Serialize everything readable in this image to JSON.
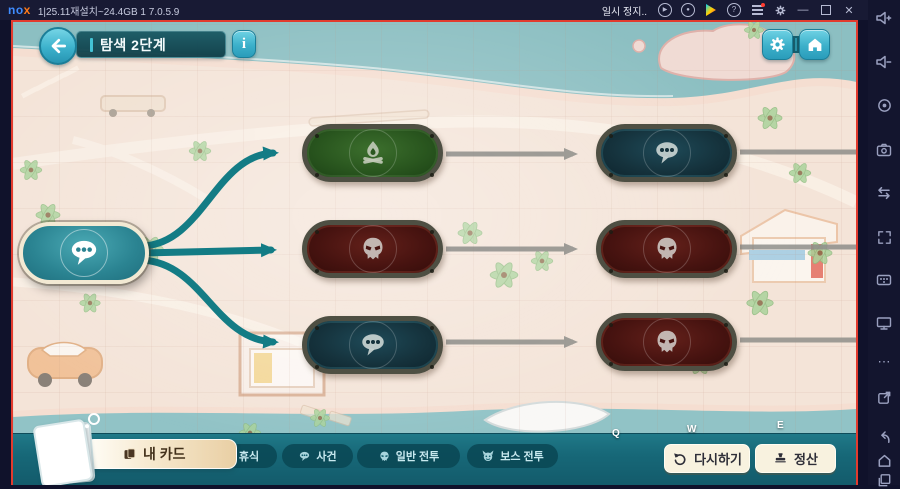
{
  "emulator": {
    "titlebar": {
      "logo_no": "no",
      "logo_x": "x",
      "window_title": "1|25.11재설치~24.4GB 1 7.0.5.9",
      "pause_text": "일시 정지..",
      "play_glyph": "▶",
      "record_glyph": "●",
      "help_glyph": "?",
      "minimize_glyph": "—",
      "close_glyph": "✕",
      "icons": [
        "play-circle-icon",
        "record-circle-icon",
        "google-play-icon",
        "help-icon",
        "menu-icon",
        "settings-icon",
        "minimize-icon",
        "maximize-icon",
        "close-icon"
      ]
    },
    "side_toolbar": {
      "more_glyph": "⋯",
      "icons": [
        "volume-up-icon",
        "volume-down-icon",
        "screen-record-icon",
        "screenshot-icon",
        "swap-icon",
        "fullscreen-icon",
        "keymap-icon",
        "virtual-screen-icon",
        "more-icon",
        "open-external-icon"
      ],
      "nav_icons": [
        "nav-back-icon",
        "nav-home-icon",
        "nav-recents-icon"
      ]
    }
  },
  "game": {
    "header": {
      "stage_title": "탐색 2단계",
      "info_glyph": "i"
    },
    "keyboard_hints": {
      "q": "Q",
      "w": "W",
      "e": "E"
    },
    "map": {
      "start_node": {
        "type": "event",
        "icon": "speech-bubble-icon",
        "state": "current"
      },
      "column1": [
        {
          "row": 1,
          "type": "rest",
          "icon": "campfire-icon"
        },
        {
          "row": 2,
          "type": "normal-battle",
          "icon": "skull-icon"
        },
        {
          "row": 3,
          "type": "event",
          "icon": "speech-bubble-icon"
        }
      ],
      "column2": [
        {
          "row": 1,
          "type": "event",
          "icon": "speech-bubble-icon"
        },
        {
          "row": 2,
          "type": "normal-battle",
          "icon": "skull-icon"
        },
        {
          "row": 3,
          "type": "normal-battle",
          "icon": "skull-icon"
        }
      ],
      "connections": {
        "active_from_start": [
          "column1-row1",
          "column1-row2",
          "column1-row3"
        ],
        "inactive": [
          "column1-row1→column2-row1",
          "column1-row2→column2-row2",
          "column1-row3→column2-row3",
          "column2-row1→east",
          "column2-row2→east",
          "column2-row3→east"
        ]
      }
    },
    "bottom_bar": {
      "my_cards_label": "내 카드",
      "legend": [
        {
          "icon": "campfire-icon",
          "label": "휴식"
        },
        {
          "icon": "speech-bubble-icon",
          "label": "사건"
        },
        {
          "icon": "skull-icon",
          "label": "일반 전투"
        },
        {
          "icon": "boss-icon",
          "label": "보스 전투"
        }
      ],
      "retry_label": "다시하기",
      "settle_label": "정산"
    },
    "colors": {
      "frame_red": "#e23b2e",
      "button_teal": "#3fb6d0",
      "bar_teal": "#1b6f7d",
      "node_rest_green": "#2a571f",
      "node_battle_red": "#471310",
      "node_event_dark": "#15323c",
      "path_active_teal": "#137c85",
      "path_inactive_gray": "#8e8e8a"
    }
  }
}
